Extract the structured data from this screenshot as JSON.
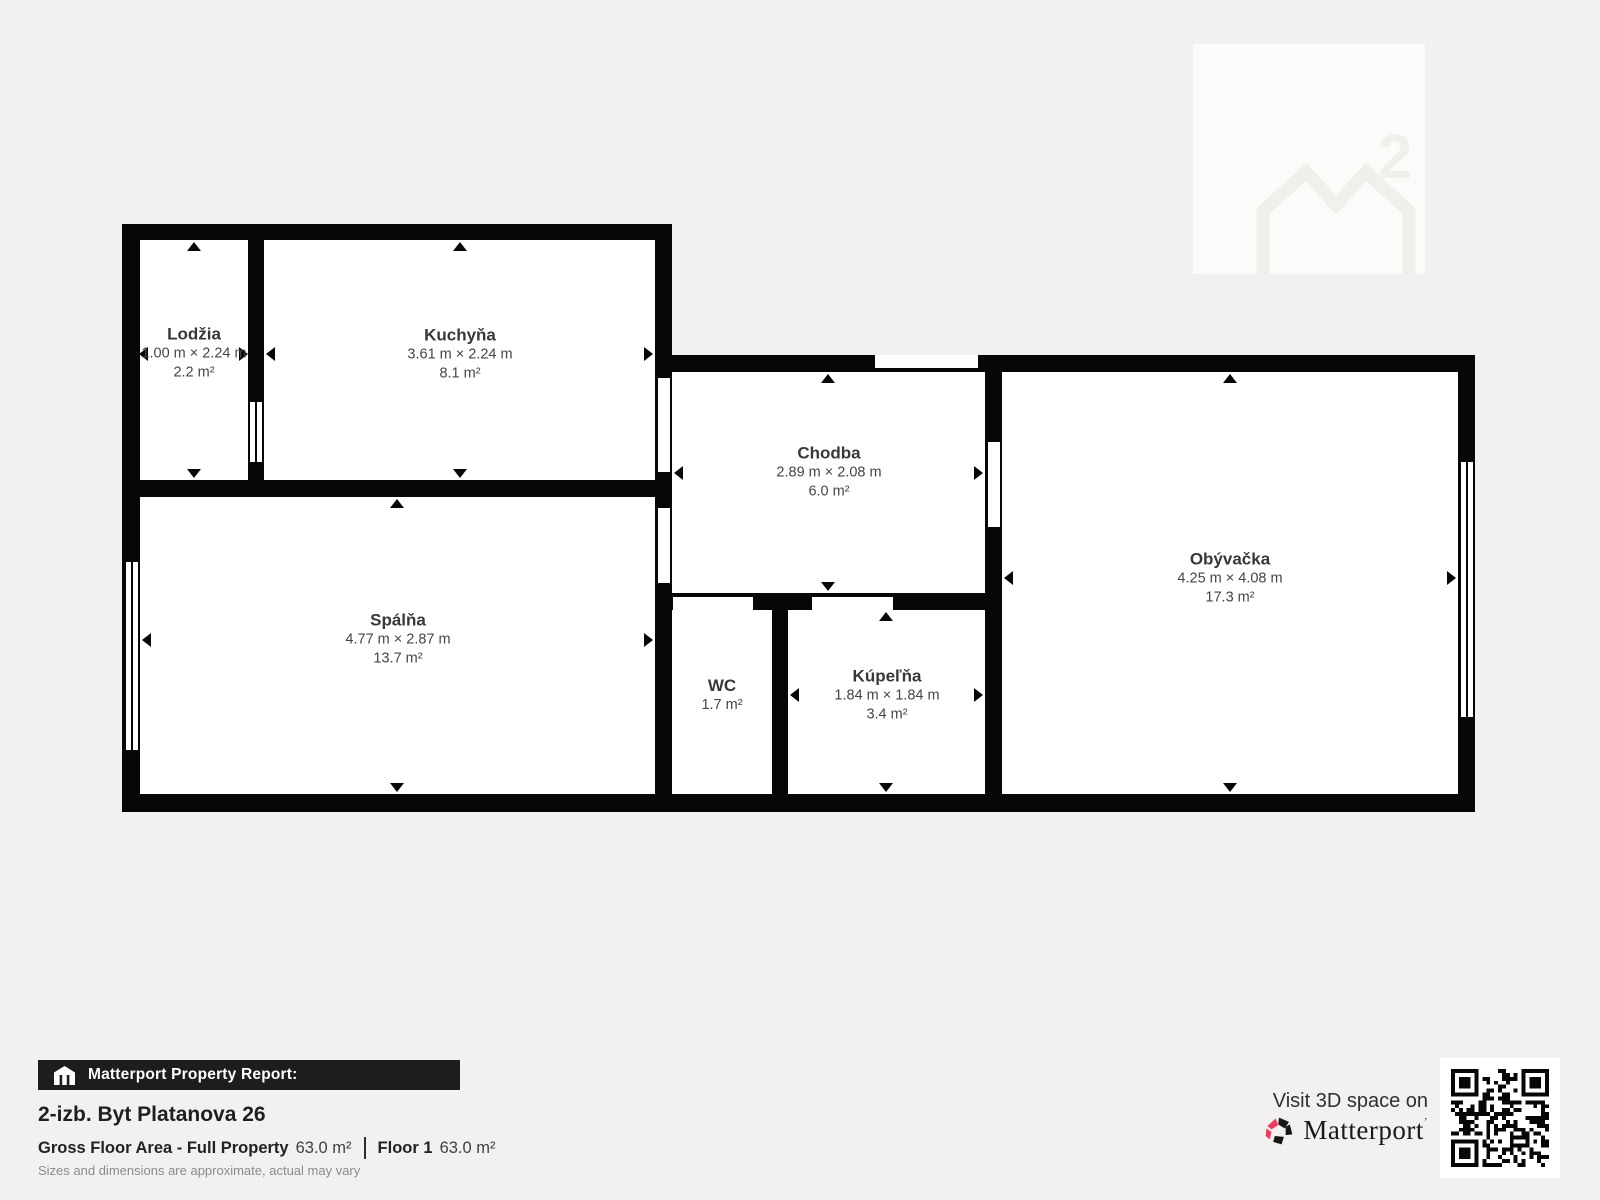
{
  "watermark": {
    "superscript": "2"
  },
  "rooms": [
    {
      "name": "Lodžia",
      "dims": "1.00 m × 2.24 m",
      "area": "2.2 m²"
    },
    {
      "name": "Kuchyňa",
      "dims": "3.61 m × 2.24 m",
      "area": "8.1 m²"
    },
    {
      "name": "Chodba",
      "dims": "2.89 m × 2.08 m",
      "area": "6.0 m²"
    },
    {
      "name": "Obývačka",
      "dims": "4.25 m × 4.08 m",
      "area": "17.3 m²"
    },
    {
      "name": "Spálňa",
      "dims": "4.77 m × 2.87 m",
      "area": "13.7 m²"
    },
    {
      "name": "WC",
      "dims": "",
      "area": "1.7 m²"
    },
    {
      "name": "Kúpeľňa",
      "dims": "1.84 m × 1.84 m",
      "area": "3.4 m²"
    }
  ],
  "report": {
    "bar_label": "Matterport Property Report:",
    "property_title": "2-izb. Byt Platanova 26",
    "gfa_label": "Gross Floor Area - Full Property",
    "gfa_value": "63.0 m²",
    "floor_label": "Floor 1",
    "floor_value": "63.0 m²",
    "disclaimer": "Sizes and dimensions are approximate, actual may vary"
  },
  "cta": {
    "visit_label": "Visit 3D space on",
    "brand": "Matterport"
  },
  "colors": {
    "accent_red": "#ee3a5c",
    "wall": "#070707",
    "background": "#f2f1ef"
  }
}
